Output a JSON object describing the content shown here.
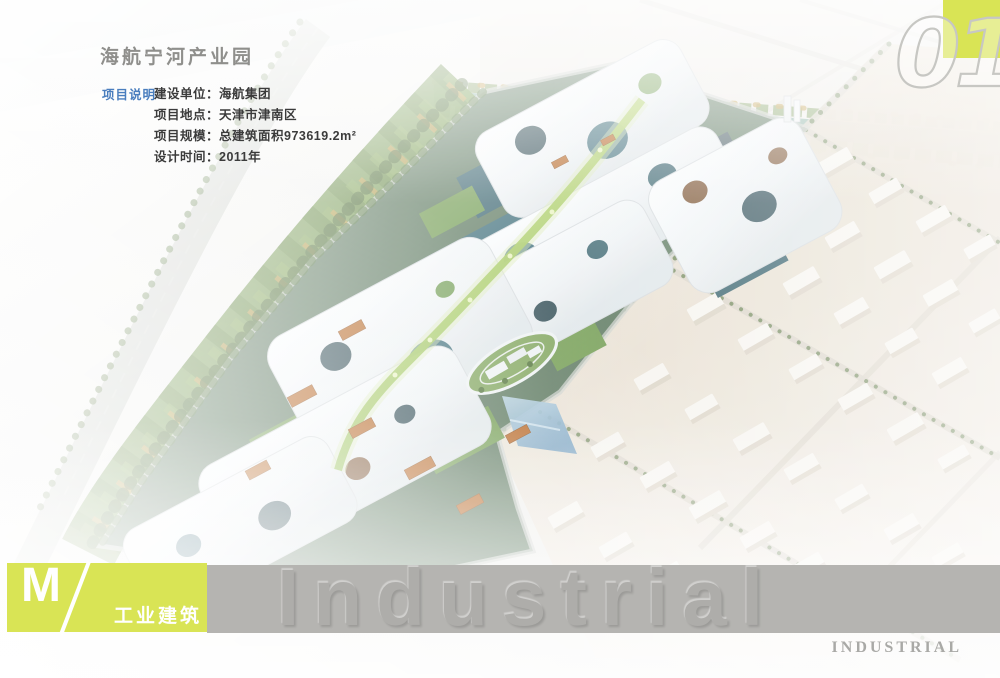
{
  "page": {
    "title": "海航宁河产业园",
    "section_label": "项目说明",
    "details": [
      "建设单位：海航集团",
      "项目地点：天津市津南区",
      "项目规模：总建筑面积973619.2m²",
      "设计时间：2011年"
    ],
    "page_number": "01"
  },
  "footer": {
    "logo_letter": "M",
    "logo_slash": "/",
    "category": "工业建筑",
    "watermark": "Industrial",
    "watermark_caps": "INDUSTRIAL"
  },
  "colors": {
    "accent_yellow_green": "#d9e455",
    "label_blue": "#4a7ebe",
    "band_gray": "#b5b4b1",
    "title_gray": "#8f8f8c",
    "water_teal": "#7da896",
    "canopy_white": "#f4f7f8",
    "glass_teal": "#35616c",
    "ground_beige": "#e5dccd"
  }
}
